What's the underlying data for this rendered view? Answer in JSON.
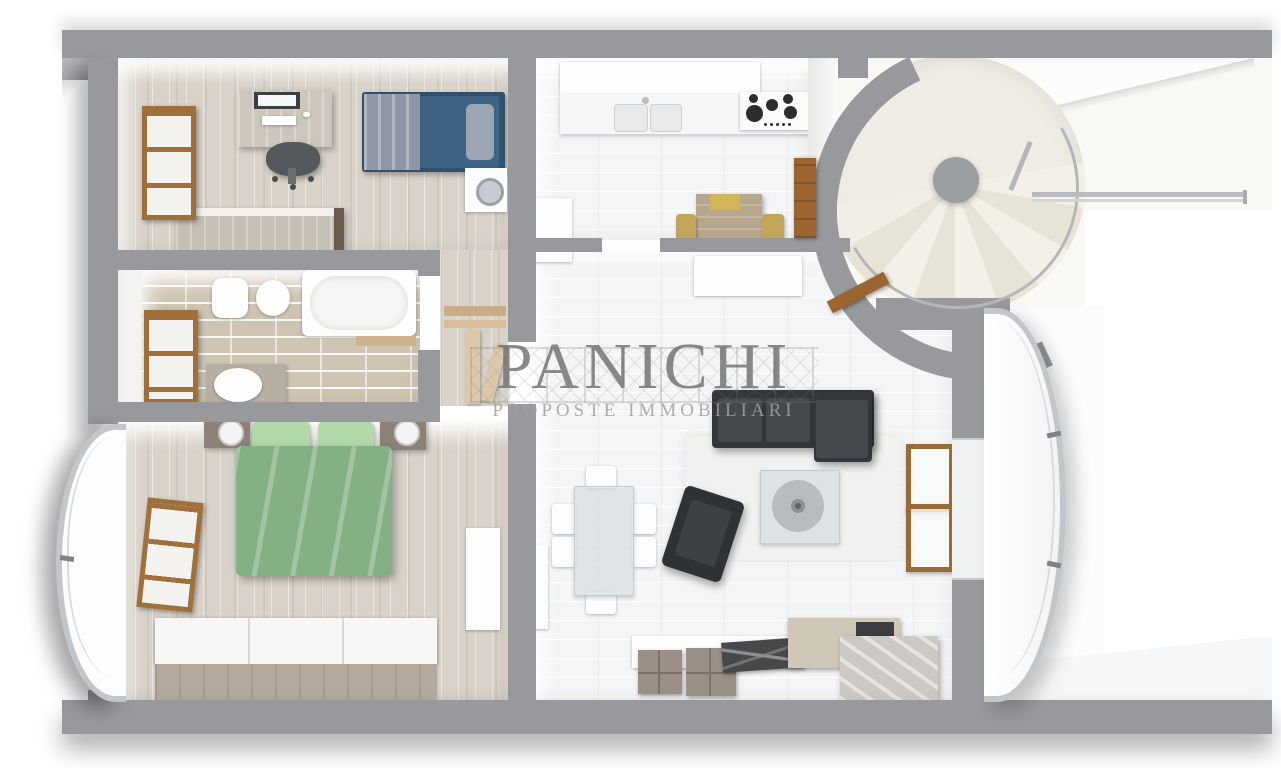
{
  "watermark": {
    "title": "PANICHI",
    "subtitle": "PROPOSTE IMMOBILIARI"
  },
  "palette": {
    "wall_gray": "#97999d",
    "wood_floor": "#d8d2c9",
    "white_tile_floor": "#f4f5f6",
    "bath_tile_floor": "#cec4b2",
    "stair_floor_cream": "#efece3",
    "window_door_wood": "#a0703a",
    "single_bed_blue": "#3e6385",
    "double_bed_green": "#84b184",
    "sofa_dark": "#3c3f42",
    "glass_blue_gray": "#d6dee1",
    "railing_gray": "#c3c6c8"
  },
  "rooms": [
    {
      "name": "studio-bedroom",
      "furniture": [
        "desk",
        "monitor",
        "office-chair",
        "single-bed",
        "washing-machine",
        "wardrobe",
        "window"
      ]
    },
    {
      "name": "bathroom",
      "furniture": [
        "toilet",
        "bidet",
        "bathtub",
        "wood-shelf",
        "vanity-sink",
        "window"
      ]
    },
    {
      "name": "hallway",
      "furniture": [
        "wall-shelves",
        "open-door"
      ]
    },
    {
      "name": "master-bedroom",
      "furniture": [
        "double-bed",
        "pillows",
        "nightstand-left",
        "nightstand-right",
        "wardrobe",
        "tall-cabinet",
        "window"
      ]
    },
    {
      "name": "kitchen",
      "furniture": [
        "upper-cabinets",
        "countertop",
        "double-sink",
        "gas-hob",
        "refrigerator",
        "breakfast-table",
        "chairs",
        "door-to-stairs"
      ]
    },
    {
      "name": "living-dining-room",
      "furniture": [
        "sofa",
        "armchair",
        "coffee-table",
        "rug",
        "dining-table",
        "dining-chairs",
        "sideboard",
        "decor-boxes",
        "open-window",
        "door-to-stairs"
      ]
    },
    {
      "name": "spiral-stair-hall",
      "furniture": [
        "spiral-staircase",
        "central-column",
        "railing"
      ]
    },
    {
      "name": "balcony-left",
      "furniture": [
        "curved-glass-railing"
      ]
    },
    {
      "name": "balcony-right",
      "furniture": [
        "curved-glass-railing"
      ]
    }
  ]
}
